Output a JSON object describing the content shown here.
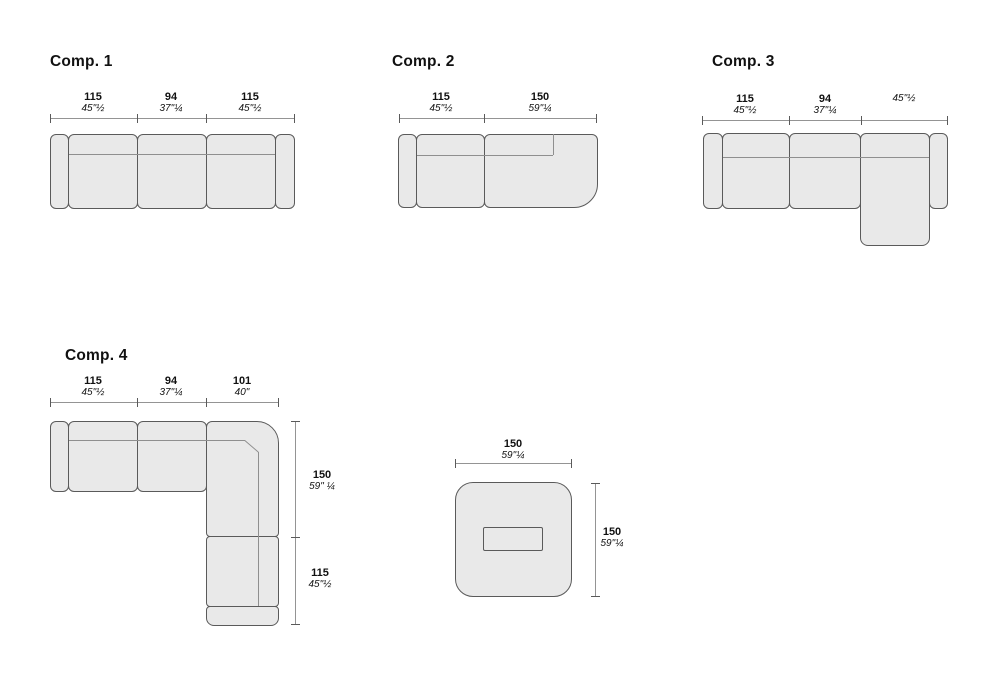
{
  "comp1": {
    "title": "Comp. 1",
    "dims": [
      {
        "cm": "115",
        "in": "45\"½"
      },
      {
        "cm": "94",
        "in": "37\"¼"
      },
      {
        "cm": "115",
        "in": "45\"½"
      }
    ]
  },
  "comp2": {
    "title": "Comp. 2",
    "dims": [
      {
        "cm": "115",
        "in": "45\"½"
      },
      {
        "cm": "150",
        "in": "59\"¼"
      }
    ]
  },
  "comp3": {
    "title": "Comp. 3",
    "dims": [
      {
        "cm": "115",
        "in": "45\"½"
      },
      {
        "cm": "94",
        "in": "37\"¼"
      },
      {
        "cm": "115",
        "in": "45\"½"
      }
    ]
  },
  "comp4": {
    "title": "Comp. 4",
    "top_dims": [
      {
        "cm": "115",
        "in": "45\"½"
      },
      {
        "cm": "94",
        "in": "37\"¼"
      },
      {
        "cm": "101",
        "in": "40\""
      }
    ],
    "side_dims": [
      {
        "cm": "150",
        "in": "59\" ¼"
      },
      {
        "cm": "115",
        "in": "45\"½"
      }
    ]
  },
  "pouf": {
    "top_dim": {
      "cm": "150",
      "in": "59\"¼"
    },
    "side_dim": {
      "cm": "150",
      "in": "59\"¼"
    }
  },
  "colors": {
    "fill": "#e9e9e9",
    "outline": "#5a5a5a",
    "backrest_line": "#8f8f8f",
    "dim_line": "#949494",
    "tick": "#5a5a5a",
    "text": "#111111",
    "background": "#ffffff"
  }
}
